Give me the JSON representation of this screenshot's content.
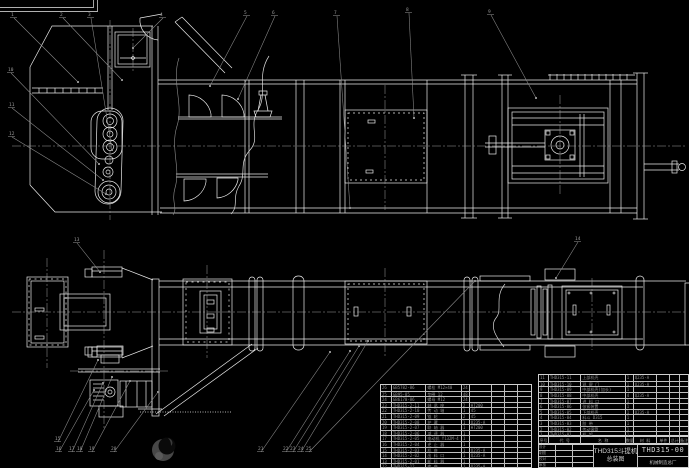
{
  "drawing": {
    "bg": "#000000",
    "line_color": "#eaeaea",
    "leader_color": "#8d8d8d",
    "centerline_color": "#b0b0b0",
    "table_line_color": "#bfbfbf",
    "table_text_color": "#8f8f8f",
    "view_side": "side-elevation-bucket-elevator",
    "view_plan": "plan-view-bucket-elevator"
  },
  "title_block": {
    "product": "THD315斗提机",
    "sheet_name": "总装图",
    "drawing_no": "THD315-00",
    "company": "机械制造总厂",
    "sign_rows": [
      [
        "设计",
        "",
        ""
      ],
      [
        "制图",
        "",
        ""
      ],
      [
        "校对",
        "",
        ""
      ],
      [
        "审核",
        "",
        ""
      ]
    ]
  },
  "bom_right": {
    "header": [
      "序号",
      "代  号",
      "名    称",
      "数量",
      "材 料",
      "单件",
      "总计",
      "备注"
    ],
    "rows": [
      [
        "11",
        "THD315-11",
        "上部机壳",
        "1",
        "Q235-A",
        "",
        "",
        ""
      ],
      [
        "10",
        "THD315-10",
        "观 察 门",
        "1",
        "Q235-A",
        "",
        "",
        ""
      ],
      [
        "9",
        "THD315-09",
        "中部机壳(加长)",
        "1",
        "",
        "",
        "",
        ""
      ],
      [
        "8",
        "THD315-08",
        "中部机壳",
        "4",
        "Q235-A",
        "",
        "",
        ""
      ],
      [
        "7",
        "THD315-07",
        "进 料 口",
        "1",
        "",
        "",
        "",
        ""
      ],
      [
        "6",
        "THD315-06",
        "张紧装置",
        "1",
        "",
        "",
        "",
        ""
      ],
      [
        "5",
        "THD315-05",
        "下部机壳",
        "1",
        "Q235-A",
        "",
        "",
        ""
      ],
      [
        "4",
        "THD315-04",
        "料斗 D315",
        "1",
        "",
        "",
        "",
        ""
      ],
      [
        "3",
        "THD315-03",
        "胶  带",
        "1",
        "",
        "",
        "",
        ""
      ],
      [
        "2",
        "THD315-02",
        "传动滚筒",
        "1",
        "",
        "",
        "",
        ""
      ],
      [
        "1",
        "THD315-01",
        "机  架",
        "1",
        "",
        "",
        "",
        ""
      ]
    ]
  },
  "bom_left": {
    "rows": [
      [
        "26",
        "GB5782-86",
        "螺栓 M12×40",
        "24",
        "",
        "",
        "",
        ""
      ],
      [
        "25",
        "GB95-85",
        "垫圈 12",
        "48",
        "",
        "",
        "",
        ""
      ],
      [
        "24",
        "GB6170-86",
        "螺母 M12",
        "24",
        "",
        "",
        "",
        ""
      ],
      [
        "23",
        "THD315-2-11",
        "轴 承 座",
        "2",
        "HT200",
        "",
        "",
        ""
      ],
      [
        "22",
        "THD315-2-10",
        "传 动 轴",
        "1",
        "45",
        "",
        "",
        ""
      ],
      [
        "21",
        "THD315-2-09",
        "链  轮",
        "2",
        "45",
        "",
        "",
        ""
      ],
      [
        "20",
        "THD315-2-08",
        "护  罩",
        "1",
        "Q235-A",
        "",
        "",
        ""
      ],
      [
        "19",
        "THD315-2-07",
        "联 轴 器",
        "1",
        "HT200",
        "",
        "",
        ""
      ],
      [
        "18",
        "THD315-2-06",
        "减 速 器",
        "1",
        "",
        "",
        "",
        ""
      ],
      [
        "17",
        "THD315-2-05",
        "电动机 Y132M-4",
        "1",
        "",
        "",
        "",
        ""
      ],
      [
        "16",
        "THD315-2-04",
        "逆 止 器",
        "1",
        "",
        "",
        "",
        ""
      ],
      [
        "15",
        "THD315-2-03",
        "机  座",
        "1",
        "Q235-A",
        "",
        "",
        ""
      ],
      [
        "14",
        "THD315-2-02",
        "出 料 口",
        "1",
        "Q235-A",
        "",
        "",
        ""
      ],
      [
        "13",
        "THD315-2-01",
        "卸 料 器",
        "1",
        "",
        "",
        "",
        ""
      ],
      [
        "12",
        "THD315-12",
        "底  座",
        "1",
        "Q235-A",
        "",
        "",
        ""
      ]
    ]
  },
  "callouts": [
    {
      "n": "1",
      "x": 11,
      "y": 16,
      "tx": 78,
      "ty": 82
    },
    {
      "n": "2",
      "x": 60,
      "y": 16,
      "tx": 122,
      "ty": 80
    },
    {
      "n": "3",
      "x": 88,
      "y": 16,
      "tx": 112,
      "ty": 150
    },
    {
      "n": "4",
      "x": 160,
      "y": 16,
      "tx": 133,
      "ty": 48
    },
    {
      "n": "5",
      "x": 244,
      "y": 14,
      "tx": 210,
      "ty": 86
    },
    {
      "n": "6",
      "x": 272,
      "y": 14,
      "tx": 238,
      "ty": 99
    },
    {
      "n": "7",
      "x": 334,
      "y": 14,
      "tx": 350,
      "ty": 208
    },
    {
      "n": "8",
      "x": 406,
      "y": 11,
      "tx": 414,
      "ty": 118
    },
    {
      "n": "9",
      "x": 488,
      "y": 13,
      "tx": 536,
      "ty": 98
    },
    {
      "n": "10",
      "x": 8,
      "y": 71,
      "tx": 99,
      "ty": 164
    },
    {
      "n": "11",
      "x": 9,
      "y": 106,
      "tx": 103,
      "ty": 180
    },
    {
      "n": "12",
      "x": 9,
      "y": 135,
      "tx": 106,
      "ty": 194
    },
    {
      "n": "13",
      "x": 74,
      "y": 241,
      "tx": 100,
      "ty": 272
    },
    {
      "n": "14",
      "x": 575,
      "y": 240,
      "tx": 556,
      "ty": 278
    },
    {
      "n": "15",
      "x": 55,
      "y": 440,
      "tx": 98,
      "ty": 360
    },
    {
      "n": "16",
      "x": 56,
      "y": 450,
      "tx": 94,
      "ty": 390
    },
    {
      "n": "17",
      "x": 69,
      "y": 450,
      "tx": 103,
      "ty": 383
    },
    {
      "n": "18",
      "x": 77,
      "y": 450,
      "tx": 112,
      "ty": 377
    },
    {
      "n": "19",
      "x": 89,
      "y": 450,
      "tx": 130,
      "ty": 381
    },
    {
      "n": "20",
      "x": 111,
      "y": 450,
      "tx": 158,
      "ty": 392
    },
    {
      "n": "21",
      "x": 258,
      "y": 450,
      "tx": 330,
      "ty": 352
    },
    {
      "n": "22",
      "x": 283,
      "y": 450,
      "tx": 350,
      "ty": 351
    },
    {
      "n": "23",
      "x": 290,
      "y": 450,
      "tx": 359,
      "ty": 346
    },
    {
      "n": "24",
      "x": 298,
      "y": 450,
      "tx": 368,
      "ty": 341
    },
    {
      "n": "25",
      "x": 306,
      "y": 450,
      "tx": 475,
      "ty": 281
    }
  ]
}
